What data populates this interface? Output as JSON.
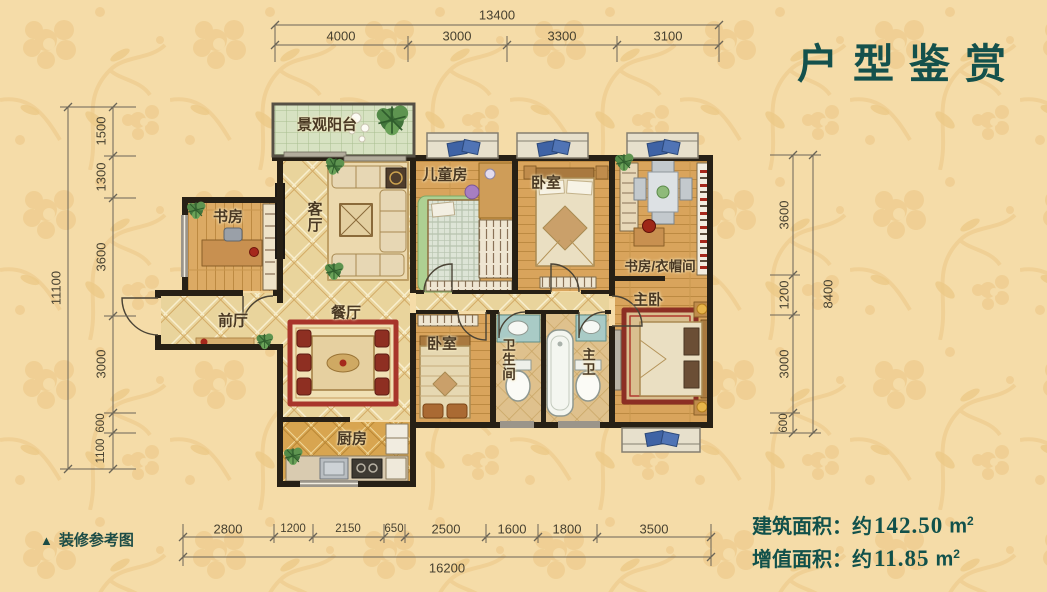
{
  "title": "户型鉴赏",
  "legend": {
    "marker": "▲",
    "label": "装修参考图"
  },
  "areas": [
    {
      "label": "建筑面积：约",
      "value": "142.50",
      "unit": "m",
      "sup": "2"
    },
    {
      "label": "增值面积：约",
      "value": "11.85",
      "unit": "m",
      "sup": "2"
    }
  ],
  "dimensions": {
    "top": {
      "total": "13400",
      "segments": [
        "4000",
        "3000",
        "3300",
        "3100"
      ]
    },
    "left": {
      "total": "11100",
      "segments": [
        "1500",
        "1300",
        "3600",
        "3000",
        "600",
        "1100"
      ]
    },
    "right": {
      "total": "8400",
      "segments": [
        "3600",
        "1200",
        "3000",
        "600"
      ]
    },
    "bottom": {
      "total": "16200",
      "segments": [
        "2800",
        "1200",
        "2150",
        "650",
        "2500",
        "1600",
        "1800",
        "3500"
      ]
    }
  },
  "rooms": {
    "balcony": "景观阳台",
    "living": "客厅",
    "study": "书房",
    "foyer": "前厅",
    "dining": "餐厅",
    "kitchen": "厨房",
    "kids": "儿童房",
    "bedroom_top": "卧室",
    "cloak": "书房/衣帽间",
    "master": "主卧",
    "bedroom_bottom": "卧室",
    "bath": "卫生间",
    "master_bath": "主卫"
  },
  "colors": {
    "accent_teal": "#14514c",
    "background": "#f5dca8",
    "wall": "#272015",
    "wood_floor": "#d9a45c",
    "tile_floor": "#e9d49c",
    "kitchen_tile": "#d8a550",
    "balcony_tile": "#d7e2c2",
    "window_gray": "#9b958a",
    "cushion_blue": "#3f63a5",
    "dining_rug_red": "#a8352b"
  }
}
